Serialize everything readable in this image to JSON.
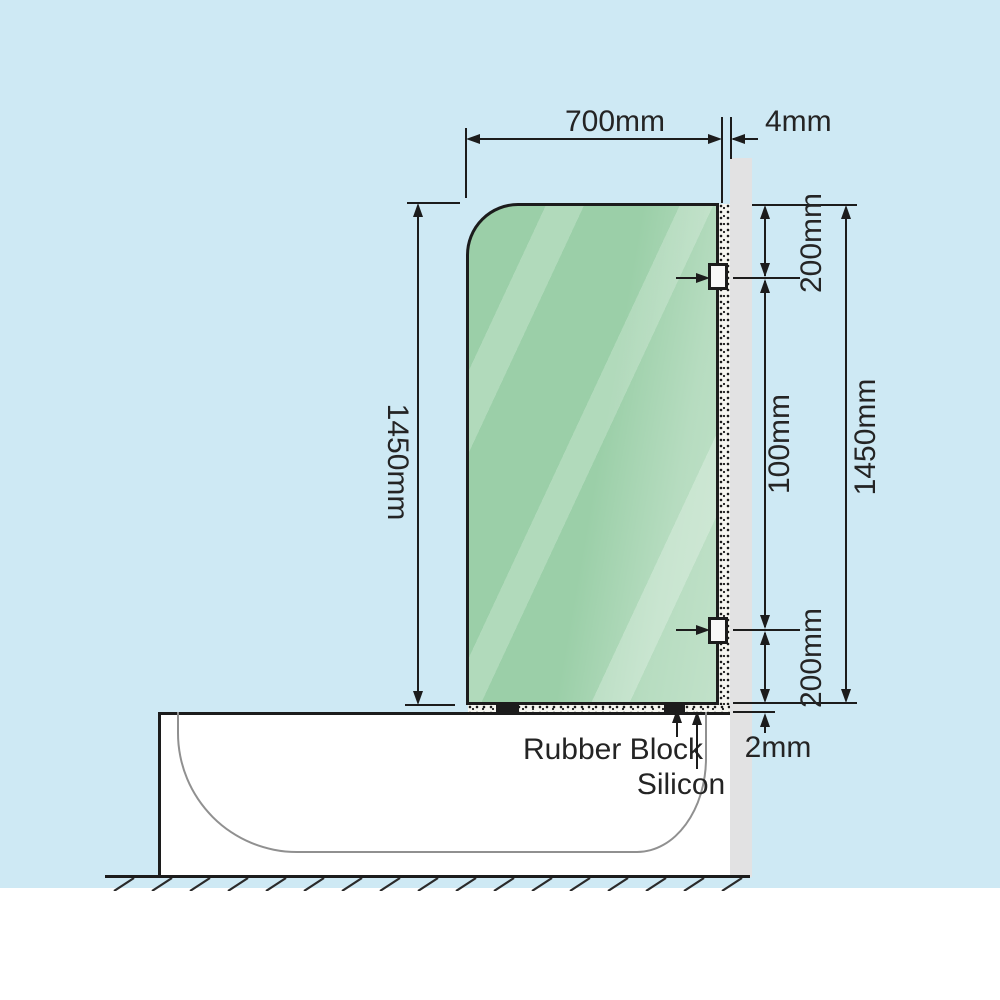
{
  "title": "Bath shower screen installation diagram",
  "dimensions": {
    "glass_width": "700mm",
    "wall_gap": "4mm",
    "glass_height_left": "1450mm",
    "glass_height_right": "1450mm",
    "top_bracket_offset": "200mm",
    "bracket_spacing": "100mm",
    "bottom_bracket_offset": "200mm",
    "bottom_gap": "2mm"
  },
  "annotations": {
    "rubber_block": "Rubber Block",
    "silicon": "Silicon"
  },
  "colors": {
    "background": "#cee9f4",
    "glass_green": "#9bcfa8",
    "wall_gray": "#e2e2e3",
    "outline": "#1c1c1c",
    "tub_inner_line": "#909090",
    "below_ground": "#ffffff"
  }
}
